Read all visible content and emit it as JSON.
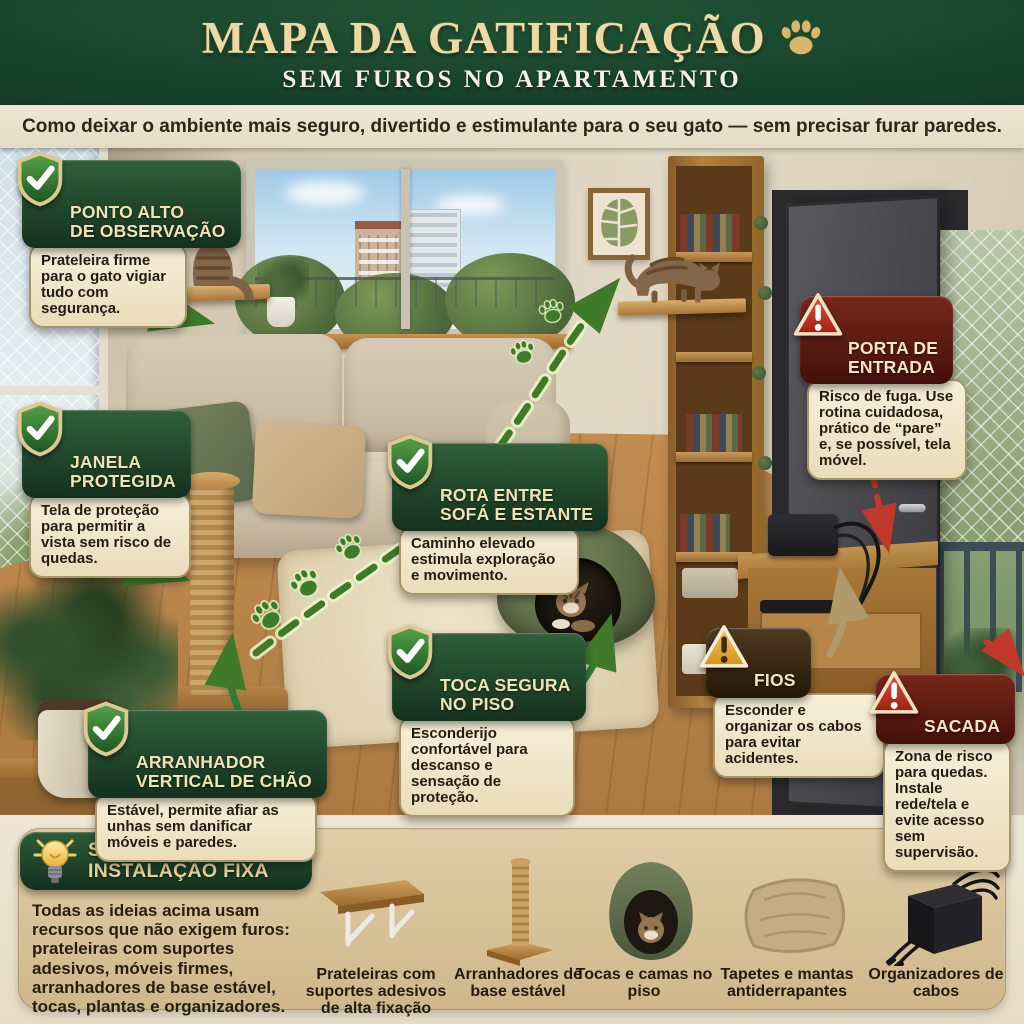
{
  "header": {
    "title": "MAPA DA GATIFICAÇÃO",
    "subtitle": "SEM FUROS NO APARTAMENTO",
    "tagline": "Como deixar o ambiente mais seguro, divertido e estimulante para o seu gato — sem precisar furar paredes.",
    "title_icon": "paw-icon"
  },
  "colors": {
    "header_green": "#17402a",
    "gold": "#ecd9a4",
    "cream_panel": "#f2e9cf",
    "safe_green": "#2d5c36",
    "danger_red": "#77281a",
    "warning_brown": "#4e3b22",
    "amber": "#e8a83c",
    "route_green": "#3f7a28",
    "route_red": "#c0392b",
    "wood": "#b0813f"
  },
  "callouts": [
    {
      "id": "ponto-alto",
      "type": "safe",
      "icon": "check-shield",
      "title": "PONTO ALTO\nDE OBSERVAÇÃO",
      "body": "Prateleira firme para o gato vigiar tudo com segurança."
    },
    {
      "id": "janela",
      "type": "safe",
      "icon": "check-shield",
      "title": "JANELA\nPROTEGIDA",
      "body": "Tela de proteção para permitir a vista sem risco de quedas."
    },
    {
      "id": "rota",
      "type": "safe",
      "icon": "check-shield",
      "title": "ROTA ENTRE\nSOFÁ E ESTANTE",
      "body": "Caminho elevado estimula exploração e movimento."
    },
    {
      "id": "porta",
      "type": "danger",
      "icon": "warning-triangle-red",
      "title": "PORTA DE\nENTRADA",
      "body": "Risco de fuga. Use rotina cuidadosa, prático de “pare” e, se possível, tela móvel."
    },
    {
      "id": "toca",
      "type": "safe",
      "icon": "check-shield",
      "title": "TOCA SEGURA\nNO PISO",
      "body": "Esconderijo confortável para descanso e sensação de proteção."
    },
    {
      "id": "fios",
      "type": "warning",
      "icon": "warning-triangle-amber",
      "title": "FIOS",
      "body": "Esconder e organizar os cabos para evitar acidentes."
    },
    {
      "id": "arranhador",
      "type": "safe",
      "icon": "check-shield",
      "title": "ARRANHADOR\nVERTICAL DE CHÃO",
      "body": "Estável, permite afiar as unhas sem danificar móveis e paredes."
    },
    {
      "id": "sacada",
      "type": "danger",
      "icon": "warning-triangle-red",
      "title": "SACADA",
      "body": "Zona de risco para quedas. Instale rede/tela e evite acesso sem supervisão."
    }
  ],
  "solutions": {
    "icon": "lightbulb",
    "title": "SOLUÇÕES SEM\nINSTALAÇÃO FIXA",
    "body": "Todas as ideias acima usam recursos que não exigem furos: prateleiras com suportes adesivos, móveis firmes, arranhadores de base estável, tocas, plantas e organizadores.",
    "items": [
      {
        "icon": "shelf",
        "label": "Prateleiras com suportes adesivos de alta fixação"
      },
      {
        "icon": "scratcher",
        "label": "Arranhadores de base estável"
      },
      {
        "icon": "cat-cave",
        "label": "Tocas e camas no piso"
      },
      {
        "icon": "mat",
        "label": "Tapetes e mantas antiderrapantes"
      },
      {
        "icon": "cable-organizer",
        "label": "Organizadores de cabos"
      }
    ]
  }
}
